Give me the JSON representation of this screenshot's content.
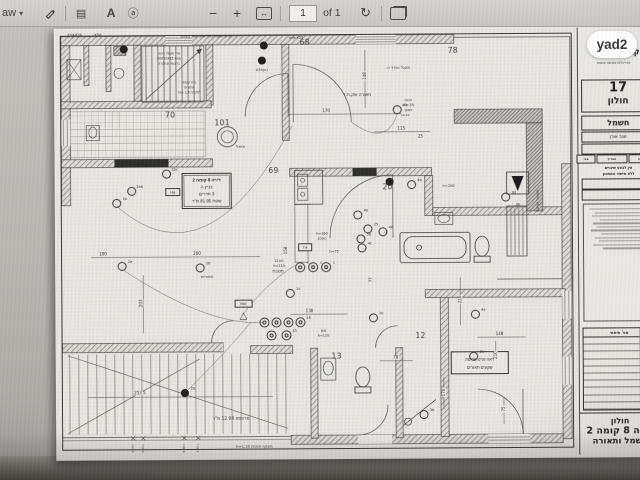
{
  "viewer": {
    "draw_label": "aw",
    "page_value": "1",
    "page_of": "of 1",
    "brand": "yad2"
  },
  "plan": {
    "rooms": [
      {
        "t": "68",
        "x": 249,
        "y": 13
      },
      {
        "t": "78",
        "x": 397,
        "y": 22
      },
      {
        "t": "70",
        "x": 114,
        "y": 85
      },
      {
        "t": "101",
        "x": 166,
        "y": 93
      },
      {
        "t": "69",
        "x": 217,
        "y": 141
      },
      {
        "t": "20",
        "x": 331,
        "y": 158
      },
      {
        "t": "12",
        "x": 363,
        "y": 307
      },
      {
        "t": "13",
        "x": 279,
        "y": 327
      }
    ],
    "info_box": {
      "lines": [
        "דירה 8 קומה 2",
        "בניין A",
        "3 חדרים",
        "שטח 81.95 מ\"ר"
      ]
    },
    "note_box": {
      "lines": [
        "ראה פרט פריסת",
        "שקעים תאורים"
      ]
    },
    "texts": [
      {
        "t": "K54/K36",
        "x": 19,
        "y": 4,
        "s": 3.4
      },
      {
        "t": "K54",
        "x": 42,
        "y": 4,
        "s": 3.4
      },
      {
        "t": "תריס חשמלי כולל שלט מעל משקוף",
        "x": 150,
        "y": 6,
        "s": 3.4
      },
      {
        "t": "K55 מאור",
        "x": 240,
        "y": 8,
        "s": 3.4
      },
      {
        "t": "(ח)K55",
        "x": 206,
        "y": 40,
        "s": 3.4
      },
      {
        "t": "מד' חשמל דירתי",
        "x": 113,
        "y": 23,
        "s": 3.2
      },
      {
        "t": "פתח 50X50X15",
        "x": 113,
        "y": 28,
        "s": 3.2
      },
      {
        "t": "ברצפה ובתקרה",
        "x": 113,
        "y": 33,
        "s": 3.2
      },
      {
        "t": "בית קומתי",
        "x": 133,
        "y": 52,
        "s": 3.2
      },
      {
        "t": "פתח עד",
        "x": 133,
        "y": 57,
        "s": 3.2
      },
      {
        "t": "לתקרה 1.3 מטר",
        "x": 133,
        "y": 62,
        "s": 3.2
      },
      {
        "t": "פאנל",
        "x": 184,
        "y": 116,
        "s": 4
      },
      {
        "t": "תאורה שק.ת.ד",
        "x": 301,
        "y": 65,
        "s": 4.4
      },
      {
        "t": "מעגל נפרד ה.",
        "x": 342,
        "y": 38,
        "s": 4
      },
      {
        "t": "הכנה",
        "x": 352,
        "y": 71,
        "s": 3.4
      },
      {
        "t": "35 ס\"מ",
        "x": 352,
        "y": 76,
        "s": 3.4
      },
      {
        "t": "למסך",
        "x": 352,
        "y": 81,
        "s": 3.4
      },
      {
        "t": "14.92",
        "x": 349,
        "y": 86,
        "s": 3
      },
      {
        "t": "מטבח",
        "x": 221,
        "y": 241,
        "s": 4.4
      },
      {
        "t": "תאורים",
        "x": 150,
        "y": 246,
        "s": 4
      },
      {
        "t": "h=200",
        "x": 392,
        "y": 157,
        "s": 3.6
      },
      {
        "t": "h=160",
        "x": 265,
        "y": 204,
        "s": 3.4
      },
      {
        "t": "(ח)10",
        "x": 265,
        "y": 209,
        "s": 3.4
      },
      {
        "t": "h=75",
        "x": 277,
        "y": 222,
        "s": 3.4
      },
      {
        "t": "(ח)11",
        "x": 222,
        "y": 231,
        "s": 3.4
      },
      {
        "t": "h=110",
        "x": 222,
        "y": 236,
        "s": 3.4
      },
      {
        "t": "מוגן",
        "x": 266,
        "y": 301,
        "s": 3.4
      },
      {
        "t": "h=110",
        "x": 266,
        "y": 306,
        "s": 3.4
      },
      {
        "t": "מסתור כביסה",
        "x": 481,
        "y": 172,
        "s": 3.8,
        "r": 1
      },
      {
        "t": "36",
        "x": 461,
        "y": 176,
        "s": 3.4
      },
      {
        "t": "מרפסת 12.04 מ\"ר",
        "x": 173,
        "y": 388,
        "s": 4.4
      },
      {
        "t": "מעקה זכוכית h=1.10",
        "x": 196,
        "y": 416,
        "s": 3.8
      },
      {
        "t": "+3.50",
        "x": 75,
        "y": 417,
        "s": 3,
        "r": 1
      },
      {
        "t": "+4.63",
        "x": 85,
        "y": 417,
        "s": 3,
        "r": 1
      },
      {
        "t": "+6.60",
        "x": 126,
        "y": 417,
        "s": 3,
        "r": 1
      },
      {
        "t": "+7.75",
        "x": 140,
        "y": 417,
        "s": 3,
        "r": 1
      }
    ],
    "dims": [
      {
        "t": "170",
        "x": 270,
        "y": 81,
        "s": 4
      },
      {
        "t": "148",
        "x": 309,
        "y": 46,
        "s": 4,
        "r": 1
      },
      {
        "t": "115",
        "x": 345,
        "y": 99,
        "s": 4
      },
      {
        "t": "25",
        "x": 364,
        "y": 107,
        "s": 4
      },
      {
        "t": "200",
        "x": 140,
        "y": 223,
        "s": 4
      },
      {
        "t": "100",
        "x": 46,
        "y": 223,
        "s": 4
      },
      {
        "t": "203",
        "x": 84,
        "y": 272,
        "s": 4,
        "r": 1
      },
      {
        "t": "253.5",
        "x": 82,
        "y": 362,
        "s": 4
      },
      {
        "t": "138",
        "x": 252,
        "y": 281,
        "s": 4
      },
      {
        "t": "158",
        "x": 229,
        "y": 220,
        "s": 4,
        "r": 1
      },
      {
        "t": "77",
        "x": 314,
        "y": 250,
        "s": 4,
        "r": 1
      },
      {
        "t": "210",
        "x": 403,
        "y": 270,
        "s": 4,
        "r": 1
      },
      {
        "t": "148",
        "x": 442,
        "y": 305,
        "s": 4
      },
      {
        "t": "210",
        "x": 438,
        "y": 326,
        "s": 4,
        "r": 1
      },
      {
        "t": "170",
        "x": 386,
        "y": 363,
        "s": 4,
        "r": 1
      },
      {
        "t": "75",
        "x": 446,
        "y": 380,
        "s": 4,
        "r": 1
      },
      {
        "t": "78",
        "x": 338,
        "y": 328,
        "s": 4
      }
    ],
    "symbols": [
      {
        "type": "f",
        "x": 68,
        "y": 18
      },
      {
        "type": "f",
        "x": 208,
        "y": 15
      },
      {
        "type": "f",
        "x": 206,
        "y": 30
      },
      {
        "type": "f",
        "x": 333,
        "y": 152
      },
      {
        "type": "f",
        "t": "2b",
        "x": 127,
        "y": 362
      },
      {
        "type": "c",
        "t": "1a",
        "x": 60,
        "y": 172
      },
      {
        "type": "c",
        "t": "2ab",
        "x": 75,
        "y": 160
      },
      {
        "type": "c",
        "t": "1bc",
        "x": 110,
        "y": 143
      },
      {
        "type": "c",
        "t": "2a",
        "x": 65,
        "y": 235
      },
      {
        "type": "c",
        "t": "2b",
        "x": 143,
        "y": 237
      },
      {
        "type": "c",
        "t": "1c",
        "x": 233,
        "y": 263
      },
      {
        "type": "c",
        "t": "4b",
        "x": 301,
        "y": 185
      },
      {
        "type": "c",
        "t": "25",
        "x": 311,
        "y": 199
      },
      {
        "type": "c",
        "t": "5b",
        "x": 304,
        "y": 209
      },
      {
        "type": "c",
        "t": "4b",
        "x": 326,
        "y": 202
      },
      {
        "type": "c",
        "t": "4c",
        "x": 305,
        "y": 218
      },
      {
        "type": "c",
        "t": "4e",
        "x": 355,
        "y": 155
      },
      {
        "type": "c",
        "t": "4a",
        "x": 341,
        "y": 80
      },
      {
        "type": "c",
        "t": "3c",
        "x": 316,
        "y": 288
      },
      {
        "type": "c",
        "t": "4e",
        "x": 418,
        "y": 285
      },
      {
        "type": "c",
        "t": "3e",
        "x": 416,
        "y": 327
      },
      {
        "type": "c",
        "t": "3d",
        "x": 449,
        "y": 168
      },
      {
        "type": "c",
        "t": "3b",
        "x": 366,
        "y": 385
      },
      {
        "type": "d",
        "t": "c",
        "x": 243,
        "y": 237
      },
      {
        "type": "d",
        "t": "c",
        "x": 256,
        "y": 237
      },
      {
        "type": "d",
        "t": "c",
        "x": 269,
        "y": 237
      },
      {
        "type": "d",
        "x": 207,
        "y": 292
      },
      {
        "type": "d",
        "x": 219,
        "y": 292
      },
      {
        "type": "d",
        "x": 231,
        "y": 292
      },
      {
        "type": "d",
        "t": "16",
        "x": 243,
        "y": 292
      },
      {
        "type": "d",
        "x": 214,
        "y": 305
      },
      {
        "type": "d",
        "t": "15",
        "x": 229,
        "y": 305
      },
      {
        "type": "b",
        "t": "Ha",
        "x": 116,
        "y": 161
      },
      {
        "type": "b",
        "t": "T4",
        "x": 248,
        "y": 217
      },
      {
        "type": "b",
        "t": "RM",
        "x": 186,
        "y": 273
      },
      {
        "type": "t",
        "x": 186,
        "y": 286
      }
    ]
  },
  "titleblock": {
    "company": "קבוצת גבסו",
    "company_sub": "אדריכלות הנדסה וביצוע",
    "project_no": "17",
    "project_city": "חולון",
    "discipline": "חשמל",
    "engineer": "שגב אורן",
    "stamp_boxes": [
      "עדכון",
      "תאריך",
      "מס'"
    ],
    "stamp_note": [
      "אין לבצע שינויים",
      "ללא אישור המתכנן"
    ],
    "table_header": "מס'    תיאור",
    "revision_rows": 10,
    "notes_lines": 12,
    "city": "חולון",
    "apartment": "דירה 8 קומה 2",
    "sheet_name": "חשמל ותאורה"
  }
}
